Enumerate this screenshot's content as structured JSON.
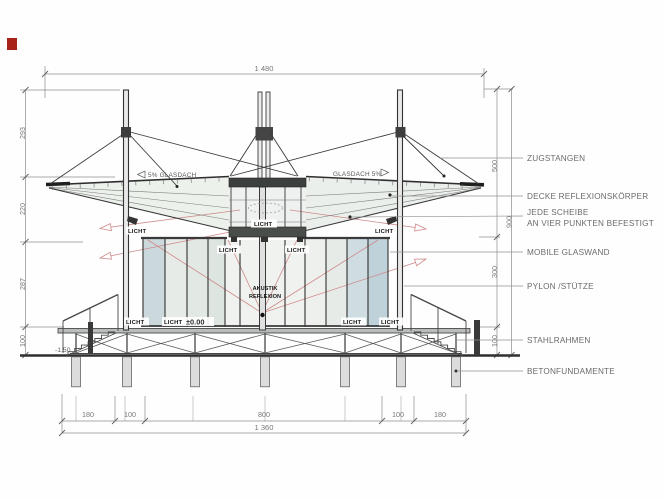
{
  "drawing": {
    "title_context": "pavilion-section-drawing",
    "dims": {
      "total_width": "1 480",
      "bottom_total": "1 360",
      "bottom": [
        "180",
        "100",
        "800",
        "100",
        "180"
      ],
      "left": [
        "293",
        "220",
        "287",
        "100"
      ],
      "right_outer": [
        "500",
        "300",
        "100"
      ],
      "right_inner": "900",
      "ground_level": "-1.50",
      "floor_level": "±0.00"
    },
    "annotations": {
      "zugstangen": "ZUGSTANGEN",
      "decke": "DECKE REFLEXIONSKÖRPER",
      "jede_scheibe_1": "JEDE SCHEIBE",
      "jede_scheibe_2": "AN VIER PUNKTEN BEFESTIGT",
      "mobile_glaswand": "MOBILE GLASWAND",
      "pylon": "PYLON /STÜTZE",
      "stahlrahmen": "STAHLRAHMEN",
      "betonfundamente": "BETONFUNDAMENTE",
      "glasdach_left": "5% GLASDACH",
      "glasdach_right": "GLASDACH 5%",
      "licht": "LICHT",
      "akustik_1": "AKUSTIK",
      "akustik_2": "REFLEXION"
    },
    "colors": {
      "line_dark": "#383838",
      "dim_gray": "#8c8c8c",
      "label_gray": "#6b6b6b",
      "glass_green": "#e9ede9",
      "glass_blue": "#c9d8de",
      "light_ray_red": "#cf8a8a",
      "marker_red": "#a82318"
    }
  }
}
